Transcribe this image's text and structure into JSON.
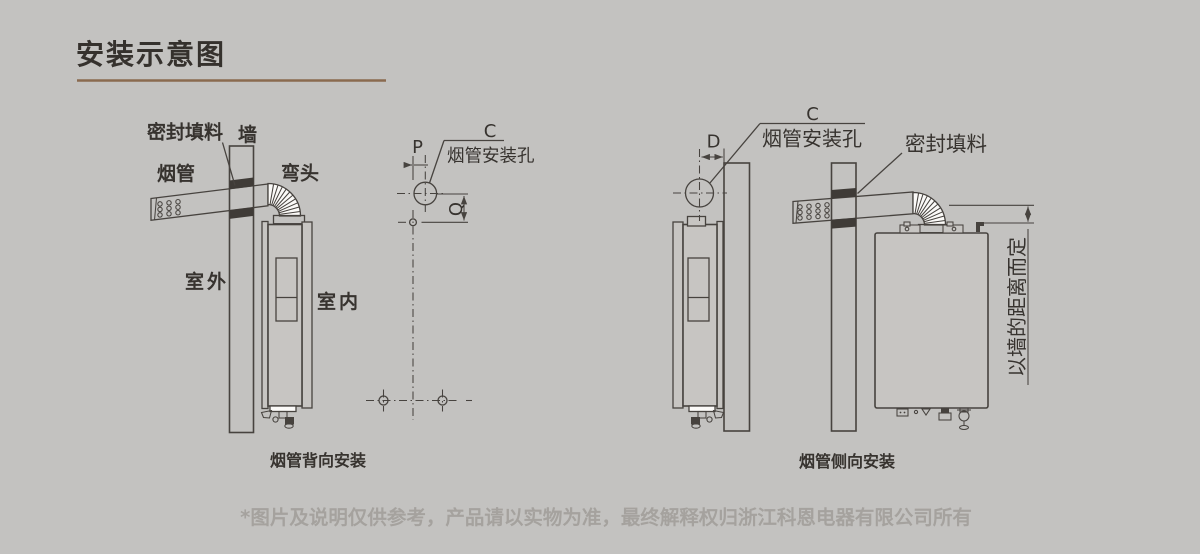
{
  "colors": {
    "background": "#c3c2c0",
    "line": "#47433f",
    "title_underline": "#8a6a4f",
    "seal_black": "#3f3b37",
    "footer_text": "#a5a29e"
  },
  "header": {
    "title": "安装示意图"
  },
  "back_install": {
    "caption": "烟管背向安装",
    "labels": {
      "seal": "密封填料",
      "wall": "墙",
      "flue_pipe": "烟管",
      "elbow": "弯头",
      "outdoor": "室外",
      "indoor": "室内"
    }
  },
  "hole_layout": {
    "dim_c": "C",
    "hole_label": "烟管安装孔",
    "dim_p": "P",
    "dim_q": "Q"
  },
  "side_install": {
    "caption": "烟管侧向安装",
    "dim_d": "D",
    "dim_c": "C",
    "hole_label": "烟管安装孔",
    "seal_label": "密封填料",
    "distance_note": "以墙的距离而定"
  },
  "footer": {
    "disclaimer": "*图片及说明仅供参考，产品请以实物为准，最终解释权归浙江科恩电器有限公司所有"
  }
}
